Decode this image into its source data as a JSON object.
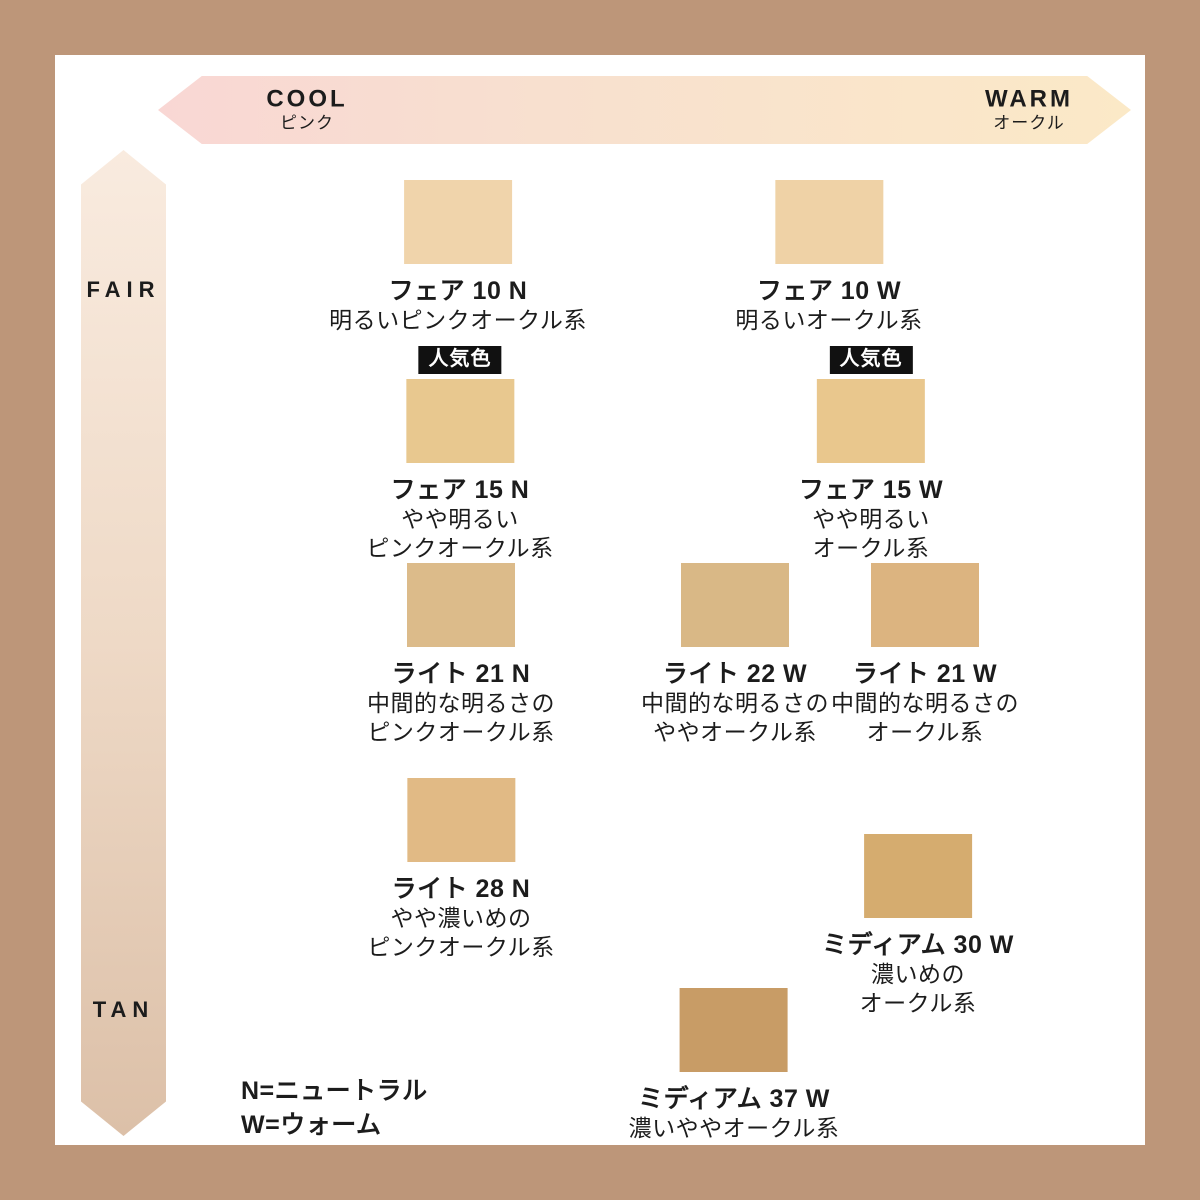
{
  "page": {
    "border_color": "#bd9679",
    "panel_background": "#ffffff"
  },
  "axes": {
    "horizontal": {
      "left_label": "COOL",
      "left_sublabel": "ピンク",
      "right_label": "WARM",
      "right_sublabel": "オークル",
      "gradient_start": "#f9d7d4",
      "gradient_end": "#fbe9c7"
    },
    "vertical": {
      "top_label": "FAIR",
      "bottom_label": "TAN",
      "gradient_start": "#f9ebdf",
      "gradient_end": "#dcc0a8"
    }
  },
  "popular_badge_label": "人気色",
  "legend": {
    "line1": "N=ニュートラル",
    "line2": "W=ウォーム"
  },
  "shades": [
    {
      "id": "fair-10-n",
      "name": "フェア 10 N",
      "desc": [
        "明るいピンクオークル系"
      ],
      "color": "#f0d4ab",
      "popular": false
    },
    {
      "id": "fair-10-w",
      "name": "フェア 10 W",
      "desc": [
        "明るいオークル系"
      ],
      "color": "#efd2a6",
      "popular": false
    },
    {
      "id": "fair-15-n",
      "name": "フェア 15 N",
      "desc": [
        "やや明るい",
        "ピンクオークル系"
      ],
      "color": "#e8c88f",
      "popular": true
    },
    {
      "id": "fair-15-w",
      "name": "フェア 15 W",
      "desc": [
        "やや明るい",
        "オークル系"
      ],
      "color": "#e9c78d",
      "popular": true
    },
    {
      "id": "light-21-n",
      "name": "ライト 21 N",
      "desc": [
        "中間的な明るさの",
        "ピンクオークル系"
      ],
      "color": "#dcbb8a",
      "popular": false
    },
    {
      "id": "light-22-w",
      "name": "ライト 22 W",
      "desc": [
        "中間的な明るさの",
        "ややオークル系"
      ],
      "color": "#d9b886",
      "popular": false
    },
    {
      "id": "light-21-w",
      "name": "ライト 21 W",
      "desc": [
        "中間的な明るさの",
        "オークル系"
      ],
      "color": "#dcb480",
      "popular": false
    },
    {
      "id": "light-28-n",
      "name": "ライト 28 N",
      "desc": [
        "やや濃いめの",
        "ピンクオークル系"
      ],
      "color": "#e1ba85",
      "popular": false
    },
    {
      "id": "medium-30-w",
      "name": "ミディアム 30 W",
      "desc": [
        "濃いめの",
        "オークル系"
      ],
      "color": "#d5ac6f",
      "popular": false
    },
    {
      "id": "medium-37-w",
      "name": "ミディアム 37 W",
      "desc": [
        "濃いややオークル系"
      ],
      "color": "#c89c66",
      "popular": false
    }
  ]
}
